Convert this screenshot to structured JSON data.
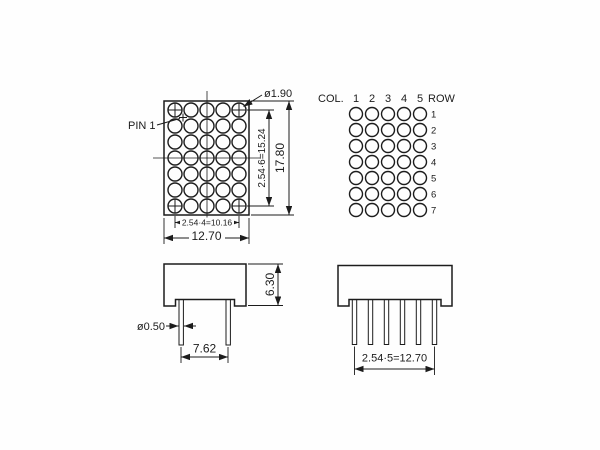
{
  "figure": {
    "background": "#ffffff",
    "line_color": "#1c1c1c",
    "front_view": {
      "pin1_label": "PIN 1",
      "led_diameter": "ø1.90",
      "row_pitch": "2.54·6=15.24",
      "body_height": "17.80",
      "col_pitch": "2.54·4=10.16",
      "body_width": "12.70",
      "grid": {
        "columns": 5,
        "rows": 7
      }
    },
    "pin_map": {
      "col_label": "COL.",
      "cols": [
        "1",
        "2",
        "3",
        "4",
        "5"
      ],
      "row_label": "ROW",
      "rows": [
        "1",
        "2",
        "3",
        "4",
        "5",
        "6",
        "7"
      ],
      "grid": {
        "columns": 5,
        "rows": 7
      }
    },
    "side_view": {
      "body_height": "6.30",
      "pin_diameter": "ø0.50",
      "pin_spacing": "7.62"
    },
    "bottom_view": {
      "pin_pitch": "2.54·5=12.70"
    }
  }
}
